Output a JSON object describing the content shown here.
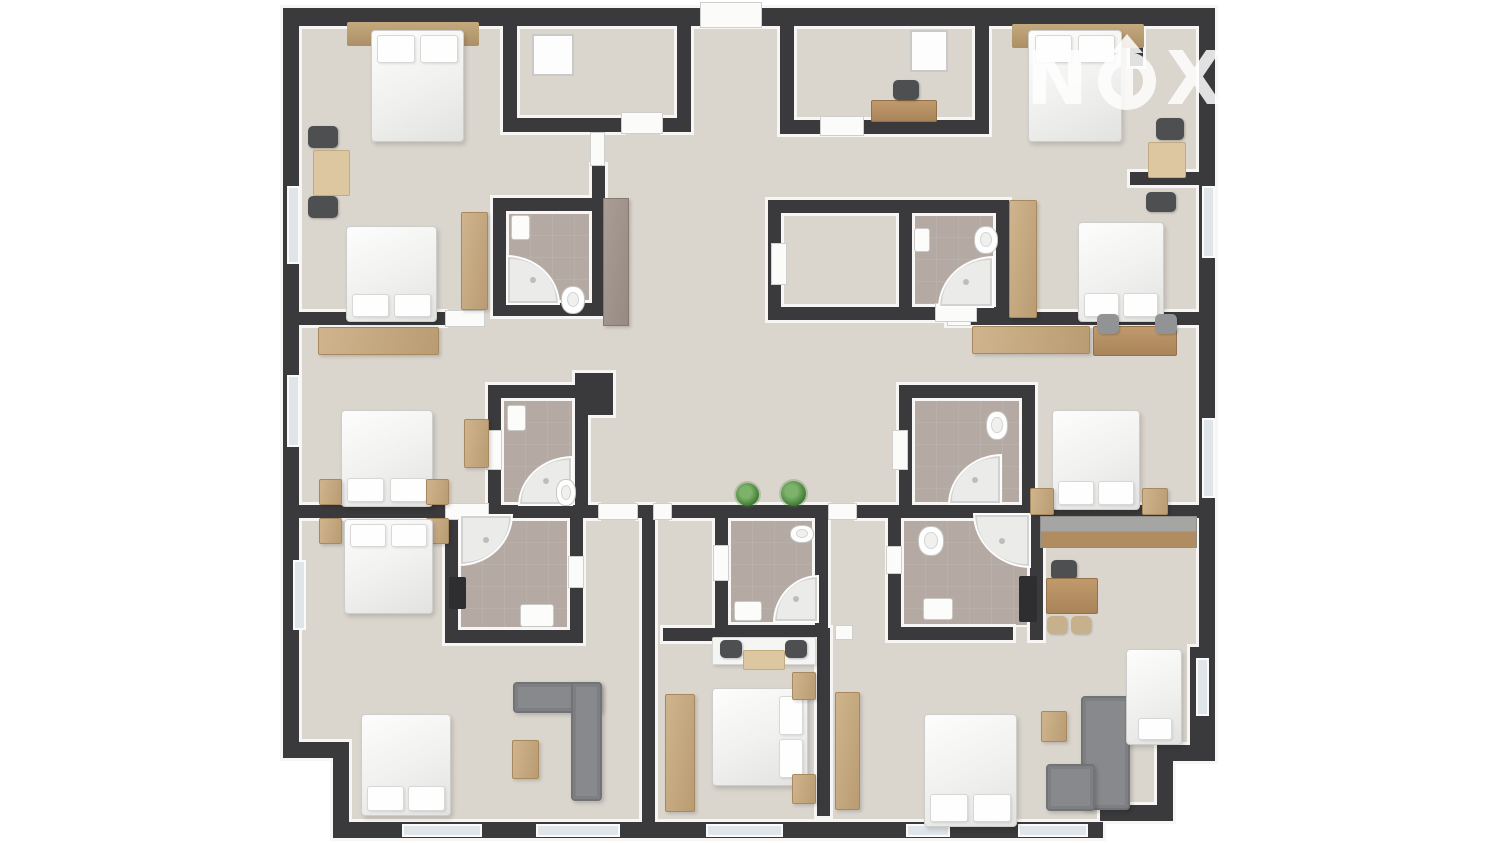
{
  "watermark": {
    "letter1": "N",
    "letter2": "X",
    "letter3": "T",
    "icon": "compass-arrow-up-in-ring",
    "color": "#ffffff",
    "opacity": 0.85
  },
  "palette": {
    "background": "#ffffff",
    "wall": "#3a3a3c",
    "wall_face": "#f7f6f4",
    "floor": "#dad5cd",
    "bathroom_floor": "#b4aaa3",
    "bed": "#f2f2f0",
    "wood": "#c2a478",
    "sofa": "#87898c",
    "plant": "#3f7c32",
    "window": "#dfe5e8"
  },
  "plan": {
    "floors": [
      [
        299,
        26,
        900,
        625
      ],
      [
        299,
        651,
        893,
        96
      ],
      [
        349,
        747,
        808,
        58
      ],
      [
        349,
        805,
        751,
        17
      ]
    ],
    "bath_floors": [
      [
        506,
        211,
        86,
        92
      ],
      [
        912,
        213,
        84,
        94
      ],
      [
        501,
        398,
        74,
        107
      ],
      [
        458,
        518,
        112,
        112
      ],
      [
        728,
        518,
        89,
        107
      ],
      [
        912,
        398,
        110,
        107
      ],
      [
        901,
        518,
        129,
        109
      ]
    ],
    "walls": [
      [
        283,
        8,
        932,
        18
      ],
      [
        283,
        8,
        16,
        742
      ],
      [
        283,
        742,
        66,
        16
      ],
      [
        333,
        742,
        16,
        90
      ],
      [
        333,
        822,
        770,
        16
      ],
      [
        1199,
        8,
        16,
        647
      ],
      [
        1190,
        647,
        25,
        108
      ],
      [
        1157,
        745,
        58,
        16
      ],
      [
        1157,
        745,
        16,
        68
      ],
      [
        1100,
        805,
        73,
        16
      ],
      [
        503,
        8,
        14,
        124
      ],
      [
        503,
        118,
        120,
        14
      ],
      [
        663,
        118,
        28,
        14
      ],
      [
        677,
        8,
        14,
        124
      ],
      [
        780,
        8,
        14,
        126
      ],
      [
        780,
        120,
        205,
        14
      ],
      [
        975,
        8,
        14,
        126
      ],
      [
        1130,
        26,
        13,
        40
      ],
      [
        1130,
        172,
        69,
        13
      ],
      [
        441,
        26,
        13,
        55
      ],
      [
        592,
        165,
        13,
        33
      ],
      [
        493,
        198,
        112,
        13
      ],
      [
        493,
        198,
        13,
        118
      ],
      [
        592,
        198,
        13,
        118
      ],
      [
        493,
        303,
        112,
        13
      ],
      [
        768,
        200,
        131,
        13
      ],
      [
        768,
        200,
        13,
        120
      ],
      [
        768,
        307,
        131,
        13
      ],
      [
        899,
        200,
        110,
        13
      ],
      [
        899,
        200,
        13,
        120
      ],
      [
        996,
        200,
        13,
        120
      ],
      [
        899,
        307,
        110,
        13
      ],
      [
        298,
        312,
        147,
        13
      ],
      [
        947,
        312,
        252,
        13
      ],
      [
        488,
        385,
        100,
        13
      ],
      [
        488,
        385,
        13,
        120
      ],
      [
        575,
        385,
        13,
        120
      ],
      [
        575,
        373,
        38,
        42
      ],
      [
        899,
        385,
        136,
        13
      ],
      [
        899,
        385,
        13,
        120
      ],
      [
        1022,
        385,
        13,
        120
      ],
      [
        298,
        505,
        147,
        13
      ],
      [
        489,
        505,
        109,
        13
      ],
      [
        638,
        505,
        15,
        13
      ],
      [
        672,
        505,
        43,
        13
      ],
      [
        715,
        505,
        113,
        13
      ],
      [
        857,
        505,
        342,
        13
      ],
      [
        445,
        510,
        13,
        128
      ],
      [
        570,
        510,
        13,
        128
      ],
      [
        445,
        630,
        138,
        13
      ],
      [
        888,
        505,
        13,
        135
      ],
      [
        1030,
        505,
        13,
        135
      ],
      [
        888,
        627,
        125,
        13
      ],
      [
        715,
        505,
        13,
        132
      ],
      [
        815,
        505,
        13,
        132
      ],
      [
        715,
        625,
        113,
        12
      ],
      [
        642,
        518,
        13,
        304
      ],
      [
        663,
        628,
        54,
        13
      ],
      [
        817,
        628,
        13,
        188
      ]
    ],
    "openings": [
      [
        700,
        2,
        62,
        26
      ],
      [
        621,
        112,
        42,
        22
      ],
      [
        820,
        116,
        44,
        20
      ],
      [
        590,
        132,
        15,
        34
      ],
      [
        441,
        81,
        15,
        34
      ],
      [
        445,
        310,
        40,
        17
      ],
      [
        947,
        309,
        24,
        17
      ],
      [
        935,
        303,
        42,
        19
      ],
      [
        771,
        243,
        16,
        42
      ],
      [
        445,
        503,
        44,
        17
      ],
      [
        598,
        503,
        40,
        17
      ],
      [
        653,
        503,
        19,
        17
      ],
      [
        828,
        503,
        29,
        17
      ],
      [
        486,
        430,
        16,
        40
      ],
      [
        568,
        556,
        16,
        32
      ],
      [
        892,
        430,
        16,
        40
      ],
      [
        886,
        546,
        16,
        28
      ],
      [
        713,
        545,
        16,
        36
      ],
      [
        835,
        625,
        18,
        15
      ]
    ],
    "windows": [
      [
        287,
        186,
        13,
        78
      ],
      [
        287,
        375,
        13,
        72
      ],
      [
        293,
        560,
        13,
        70
      ],
      [
        402,
        824,
        80,
        13
      ],
      [
        536,
        824,
        84,
        13
      ],
      [
        706,
        824,
        77,
        13
      ],
      [
        906,
        824,
        44,
        13
      ],
      [
        1018,
        824,
        70,
        13
      ],
      [
        1202,
        186,
        13,
        72
      ],
      [
        1202,
        418,
        13,
        80
      ],
      [
        1196,
        658,
        13,
        58
      ]
    ],
    "furniture": [
      {
        "t": "headboard",
        "r": [
          347,
          22,
          132,
          24
        ]
      },
      {
        "t": "bed",
        "r": [
          371,
          30,
          93,
          112
        ],
        "head": "n"
      },
      {
        "t": "chair-dark",
        "r": [
          308,
          126,
          30,
          22
        ]
      },
      {
        "t": "chair-dark",
        "r": [
          308,
          196,
          30,
          22
        ]
      },
      {
        "t": "table",
        "r": [
          313,
          150,
          37,
          46
        ]
      },
      {
        "t": "bed",
        "r": [
          346,
          226,
          91,
          96
        ],
        "head": "s"
      },
      {
        "t": "wardrobe",
        "r": [
          461,
          212,
          27,
          98
        ]
      },
      {
        "t": "dresser",
        "r": [
          603,
          198,
          26,
          128
        ]
      },
      {
        "t": "mat",
        "r": [
          532,
          34,
          42,
          42
        ]
      },
      {
        "t": "board",
        "r": [
          910,
          30,
          38,
          42
        ]
      },
      {
        "t": "desk-wood",
        "r": [
          871,
          100,
          66,
          22
        ]
      },
      {
        "t": "chair-dark",
        "r": [
          893,
          80,
          26,
          20
        ]
      },
      {
        "t": "headboard",
        "r": [
          1012,
          24,
          132,
          24
        ]
      },
      {
        "t": "bed",
        "r": [
          1028,
          30,
          94,
          112
        ],
        "head": "n"
      },
      {
        "t": "chair-dark",
        "r": [
          1156,
          118,
          28,
          22
        ]
      },
      {
        "t": "table",
        "r": [
          1148,
          142,
          38,
          36
        ]
      },
      {
        "t": "chair-dark",
        "r": [
          1146,
          192,
          30,
          20
        ]
      },
      {
        "t": "wardrobe",
        "r": [
          1009,
          200,
          28,
          118
        ]
      },
      {
        "t": "sink",
        "r": [
          511,
          215,
          19,
          25
        ]
      },
      {
        "t": "shower",
        "r": [
          506,
          255,
          54,
          50
        ],
        "c": "tr"
      },
      {
        "t": "toilet",
        "r": [
          561,
          286,
          24,
          28
        ]
      },
      {
        "t": "sink",
        "r": [
          914,
          228,
          16,
          24
        ]
      },
      {
        "t": "shower",
        "r": [
          938,
          256,
          56,
          52
        ],
        "c": "tl"
      },
      {
        "t": "toilet",
        "r": [
          974,
          226,
          24,
          28
        ]
      },
      {
        "t": "bed",
        "r": [
          1078,
          222,
          86,
          100
        ],
        "head": "s"
      },
      {
        "t": "sideboard",
        "r": [
          972,
          326,
          118,
          28
        ]
      },
      {
        "t": "desk-wood",
        "r": [
          1093,
          326,
          84,
          30
        ]
      },
      {
        "t": "chair-gray",
        "r": [
          1097,
          314,
          22,
          20
        ]
      },
      {
        "t": "chair-gray",
        "r": [
          1155,
          314,
          22,
          20
        ]
      },
      {
        "t": "sideboard",
        "r": [
          318,
          327,
          121,
          28
        ]
      },
      {
        "t": "bed",
        "r": [
          341,
          410,
          92,
          97
        ],
        "head": "s"
      },
      {
        "t": "wardrobe",
        "r": [
          464,
          419,
          25,
          49
        ]
      },
      {
        "t": "nightstand",
        "r": [
          319,
          479,
          23,
          26
        ]
      },
      {
        "t": "nightstand",
        "r": [
          426,
          479,
          23,
          26
        ]
      },
      {
        "t": "nightstand",
        "r": [
          319,
          518,
          23,
          26
        ]
      },
      {
        "t": "nightstand",
        "r": [
          426,
          518,
          23,
          26
        ]
      },
      {
        "t": "bed",
        "r": [
          344,
          519,
          89,
          95
        ],
        "head": "n"
      },
      {
        "t": "sink",
        "r": [
          507,
          405,
          19,
          26
        ]
      },
      {
        "t": "shower",
        "r": [
          518,
          456,
          55,
          50
        ],
        "c": "tl"
      },
      {
        "t": "toilet",
        "r": [
          556,
          479,
          20,
          27
        ]
      },
      {
        "t": "shower",
        "r": [
          459,
          514,
          54,
          52
        ],
        "c": "br"
      },
      {
        "t": "appliance",
        "r": [
          449,
          577,
          17,
          32
        ]
      },
      {
        "t": "sink",
        "r": [
          520,
          604,
          34,
          23
        ]
      },
      {
        "t": "toilet",
        "r": [
          790,
          525,
          24,
          18
        ]
      },
      {
        "t": "shower",
        "r": [
          773,
          575,
          46,
          48
        ],
        "c": "tl"
      },
      {
        "t": "sink",
        "r": [
          734,
          601,
          28,
          20
        ]
      },
      {
        "t": "towel",
        "r": [
          746,
          637,
          46,
          21
        ]
      },
      {
        "t": "toilet",
        "r": [
          986,
          411,
          22,
          29
        ]
      },
      {
        "t": "shower",
        "r": [
          948,
          454,
          54,
          51
        ],
        "c": "tl"
      },
      {
        "t": "toilet",
        "r": [
          918,
          526,
          26,
          30
        ]
      },
      {
        "t": "shower",
        "r": [
          973,
          513,
          58,
          55
        ],
        "c": "bl"
      },
      {
        "t": "sink",
        "r": [
          923,
          598,
          30,
          22
        ]
      },
      {
        "t": "appliance",
        "r": [
          1019,
          576,
          18,
          46
        ]
      },
      {
        "t": "plant",
        "r": [
          736,
          483,
          23,
          23
        ]
      },
      {
        "t": "plant",
        "r": [
          781,
          481,
          25,
          25
        ]
      },
      {
        "t": "bed",
        "r": [
          1052,
          410,
          88,
          100
        ],
        "head": "s"
      },
      {
        "t": "nightstand",
        "r": [
          1030,
          488,
          24,
          27
        ]
      },
      {
        "t": "nightstand",
        "r": [
          1142,
          488,
          26,
          27
        ]
      },
      {
        "t": "counter",
        "r": [
          1040,
          516,
          157,
          32
        ]
      },
      {
        "t": "chair-dark",
        "r": [
          1051,
          560,
          26,
          20
        ]
      },
      {
        "t": "desk-wood",
        "r": [
          1046,
          578,
          52,
          36
        ]
      },
      {
        "t": "chair-tan",
        "r": [
          1047,
          616,
          20,
          18
        ]
      },
      {
        "t": "chair-tan",
        "r": [
          1071,
          616,
          20,
          18
        ]
      },
      {
        "t": "bed",
        "r": [
          361,
          714,
          90,
          102
        ],
        "head": "s"
      },
      {
        "t": "sofa",
        "r": [
          513,
          682,
          89,
          31
        ]
      },
      {
        "t": "sofa",
        "r": [
          571,
          682,
          31,
          119
        ]
      },
      {
        "t": "ctable",
        "r": [
          512,
          740,
          27,
          39
        ]
      },
      {
        "t": "desk-white",
        "r": [
          712,
          637,
          104,
          28
        ]
      },
      {
        "t": "chair-dark",
        "r": [
          720,
          640,
          22,
          18
        ]
      },
      {
        "t": "chair-dark",
        "r": [
          785,
          640,
          22,
          18
        ]
      },
      {
        "t": "rug",
        "r": [
          743,
          650,
          42,
          20
        ]
      },
      {
        "t": "wardrobe",
        "r": [
          665,
          694,
          30,
          118
        ]
      },
      {
        "t": "bed",
        "r": [
          712,
          688,
          96,
          98
        ],
        "head": "e"
      },
      {
        "t": "nightstand",
        "r": [
          792,
          672,
          24,
          28
        ]
      },
      {
        "t": "nightstand",
        "r": [
          792,
          774,
          24,
          30
        ]
      },
      {
        "t": "wardrobe",
        "r": [
          835,
          692,
          25,
          118
        ]
      },
      {
        "t": "bed",
        "r": [
          924,
          714,
          93,
          113
        ],
        "head": "s"
      },
      {
        "t": "nightstand",
        "r": [
          1041,
          711,
          26,
          31
        ]
      },
      {
        "t": "sofa",
        "r": [
          1081,
          696,
          49,
          114
        ]
      },
      {
        "t": "sofa",
        "r": [
          1046,
          764,
          49,
          47
        ]
      },
      {
        "t": "bed",
        "r": [
          1126,
          649,
          56,
          96
        ],
        "head": "s",
        "p": 1
      }
    ]
  }
}
